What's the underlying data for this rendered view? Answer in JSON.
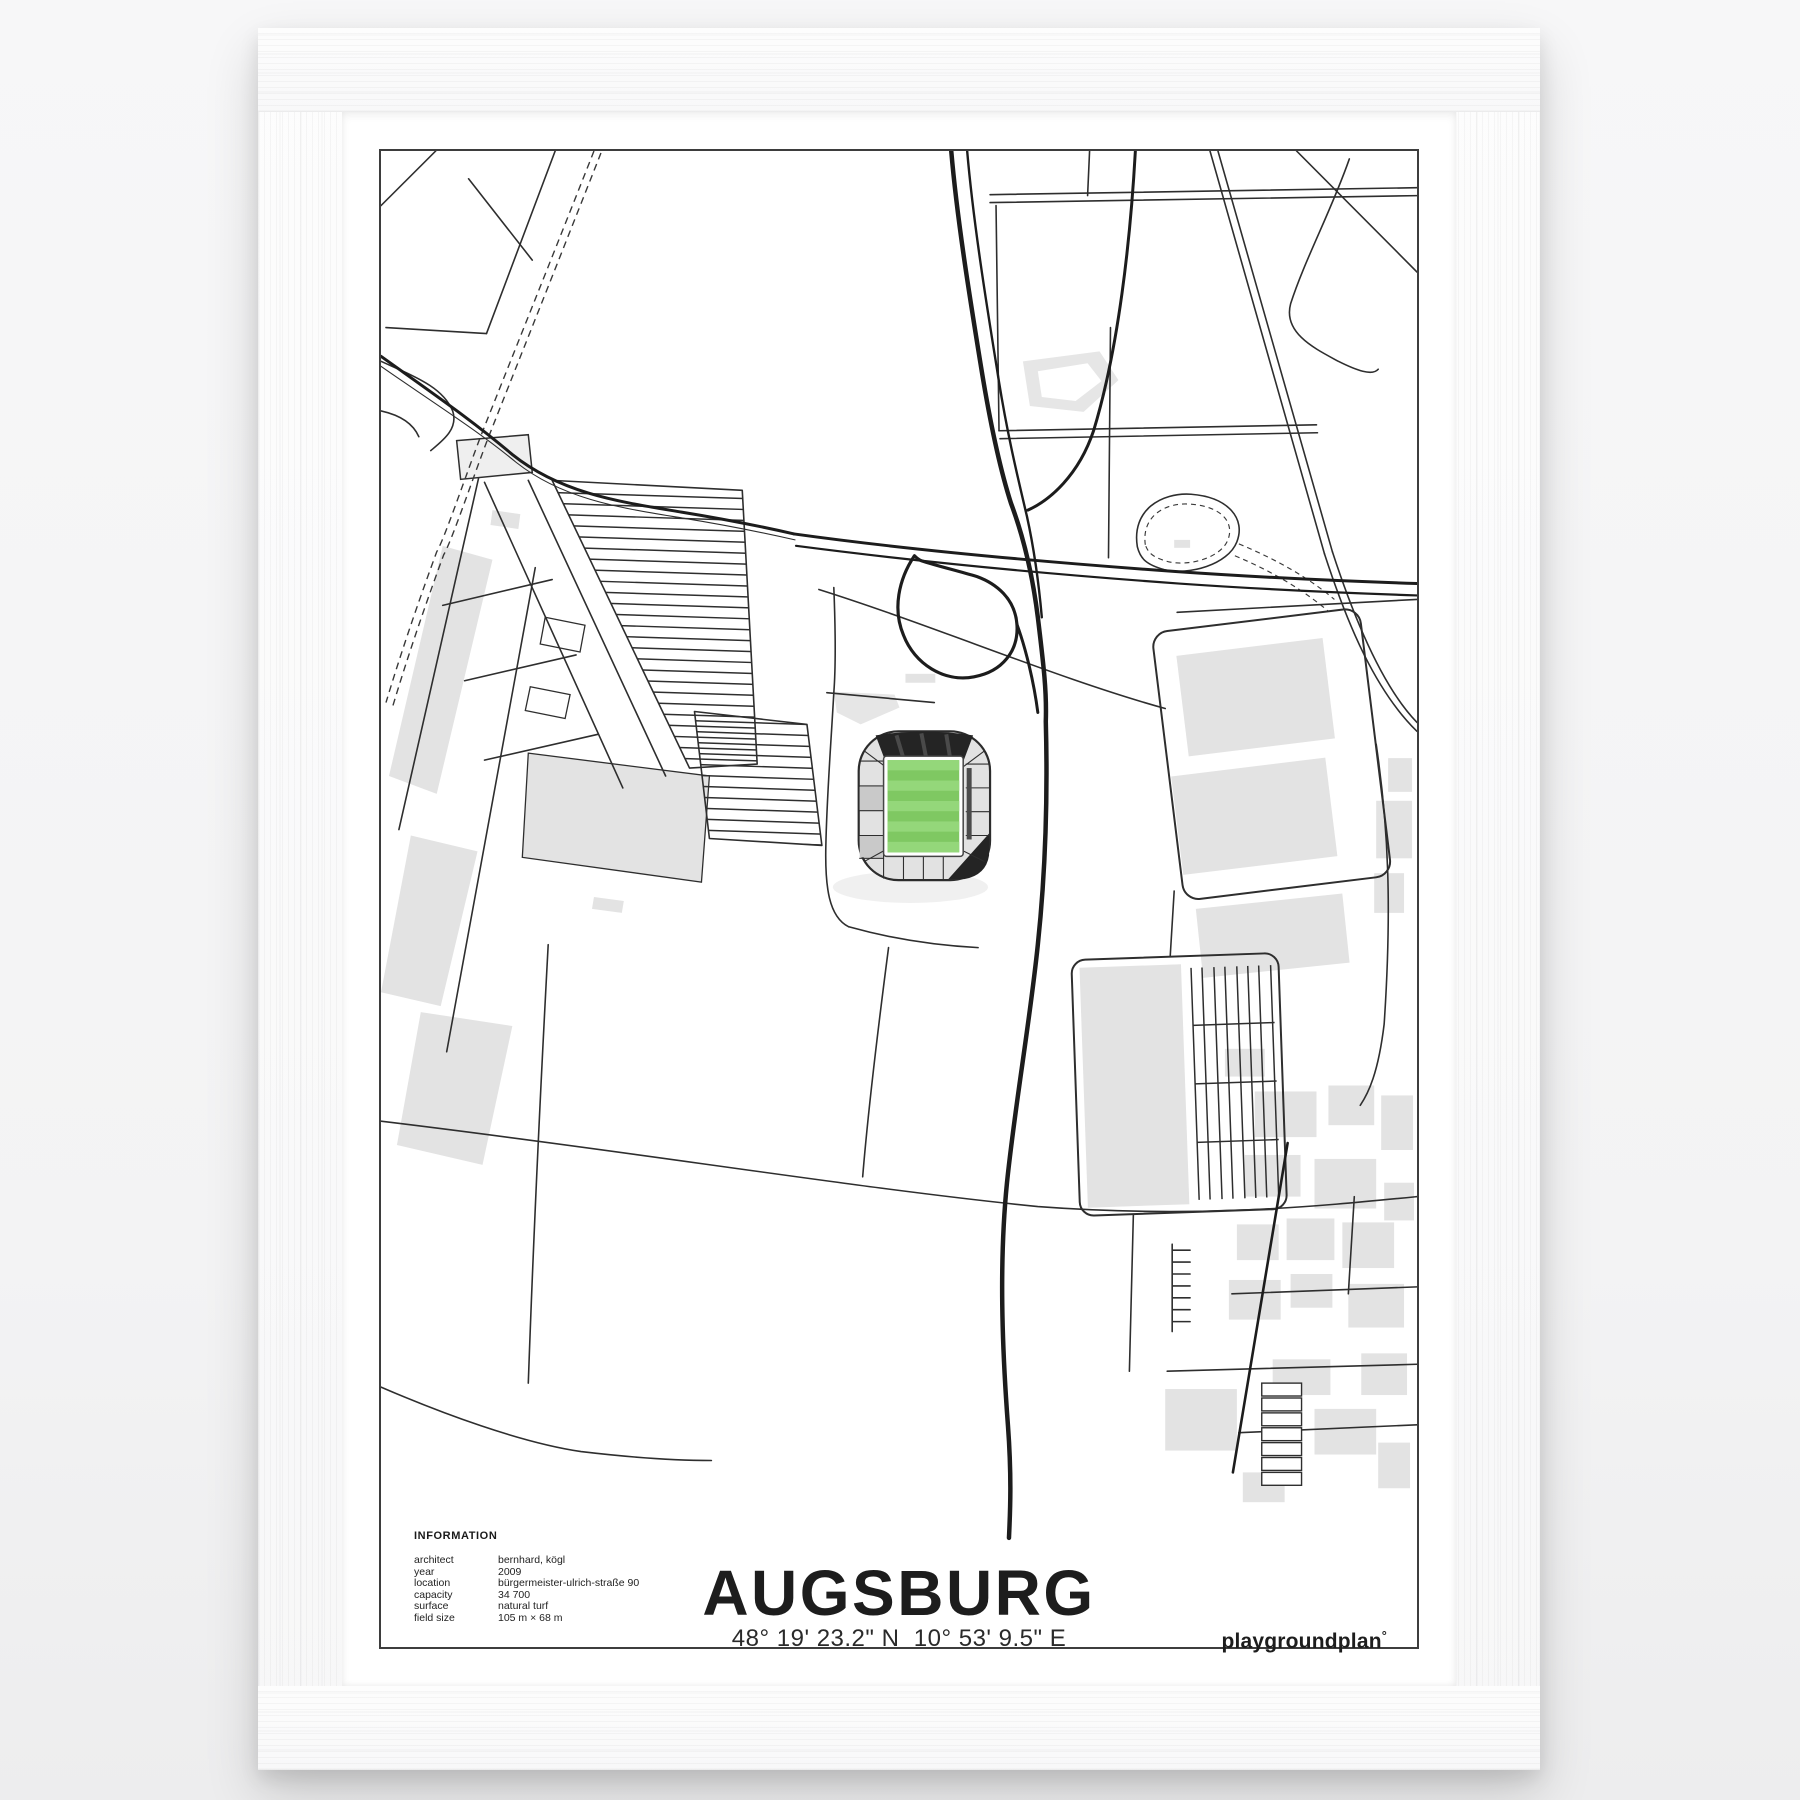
{
  "poster": {
    "title": "AUGSBURG",
    "coordinates": "48° 19' 23.2\" N  10° 53' 9.5\" E",
    "brand": "playgroundplan",
    "brand_mark": "°",
    "information": {
      "heading": "INFORMATION",
      "rows": [
        {
          "label": "architect",
          "value": "bernhard, kögl"
        },
        {
          "label": "year",
          "value": "2009"
        },
        {
          "label": "location",
          "value": "bürgermeister-ulrich-straße 90"
        },
        {
          "label": "capacity",
          "value": "34 700"
        },
        {
          "label": "surface",
          "value": "natural turf"
        },
        {
          "label": "field size",
          "value": "105 m × 68 m"
        }
      ]
    }
  },
  "map": {
    "subject": "stadium street map, Augsburg arena area",
    "colors": {
      "line": "#2e2e2e",
      "road_dark": "#1c1c1c",
      "building_grey": "#e3e3e3",
      "stand_grey": "#e2e2e2",
      "stand_dark_grey": "#c9c9c9",
      "roof_dark": "#242424",
      "pitch_green": "#7fc862",
      "pitch_green_light": "#94d77a",
      "paper": "#ffffff",
      "frame_white": "#fbfbfb"
    }
  }
}
